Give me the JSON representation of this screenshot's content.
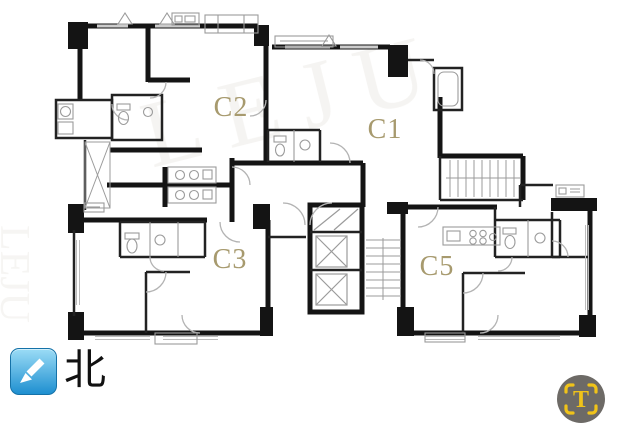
{
  "plan": {
    "units": [
      {
        "label": "C1"
      },
      {
        "label": "C2"
      },
      {
        "label": "C3"
      },
      {
        "label": "C5"
      }
    ],
    "label_color": "#a79a6e",
    "watermark_text": "LEJU",
    "icons": {
      "elevator": "elevator-shaft-x-icon",
      "stairs": "stair-treads-icon"
    },
    "colors": {
      "wall": "#141414",
      "detail_line": "#9b9b9b",
      "door_arc": "#b3b3b3",
      "background": "#ffffff"
    }
  },
  "north_indicator": {
    "label": "北",
    "icon": "southwest-arrow-icon",
    "box_color_top": "#9bdcf6",
    "box_color_bottom": "#1e8fd0",
    "arrow_color": "#ffffff"
  },
  "badge": {
    "letter": "T",
    "icon": "scan-frame-icon",
    "circle_color": "#6d6a66",
    "accent_color": "#f0c319"
  }
}
